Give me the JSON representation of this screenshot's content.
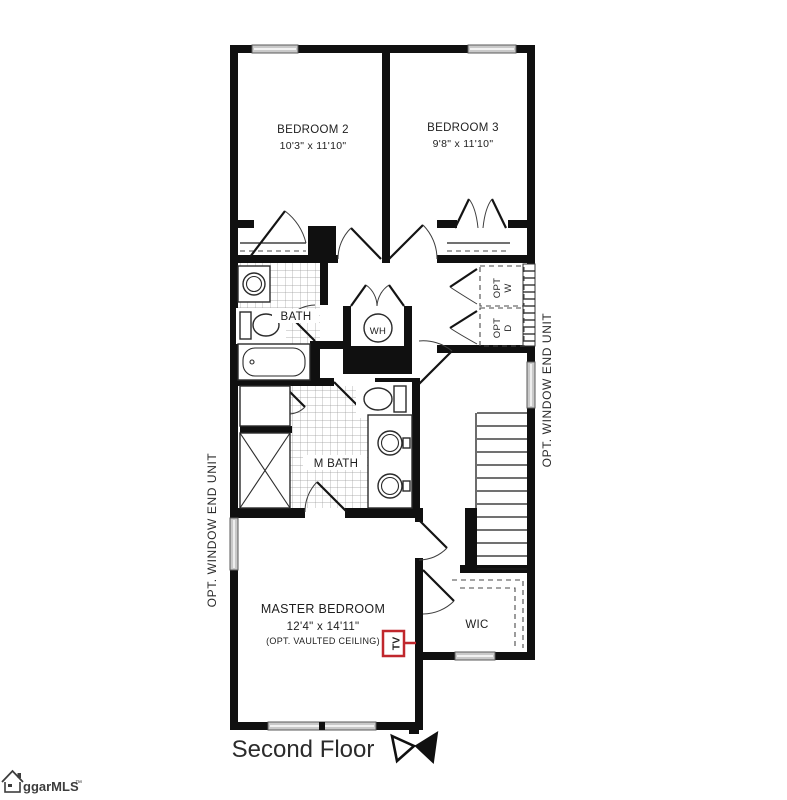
{
  "rooms": {
    "bedroom2": {
      "name": "BEDROOM 2",
      "dims": "10'3\" x 11'10\""
    },
    "bedroom3": {
      "name": "BEDROOM 3",
      "dims": "9'8\" x 11'10\""
    },
    "bath": {
      "name": "BATH"
    },
    "master_bath": {
      "name": "M BATH"
    },
    "master_bedroom": {
      "name": "MASTER BEDROOM",
      "dims": "12'4\" x 14'11\"",
      "note": "(OPT. VAULTED CEILING)"
    },
    "wic": {
      "name": "WIC"
    },
    "water_heater": {
      "label": "WH"
    },
    "opt_washer": {
      "line1": "OPT",
      "line2": "W"
    },
    "opt_dryer": {
      "line1": "OPT",
      "line2": "D"
    }
  },
  "annotations": {
    "opt_window_left": "OPT. WINDOW END UNIT",
    "opt_window_right": "OPT. WINDOW END UNIT",
    "tv_marker": "TV",
    "floor_title": "Second Floor"
  },
  "branding": {
    "logo_text": "ggarMLS",
    "trademark": "™"
  },
  "colors": {
    "wall": "#101010",
    "tv_red": "#c0272d",
    "window_fill": "#c9c9c9"
  }
}
